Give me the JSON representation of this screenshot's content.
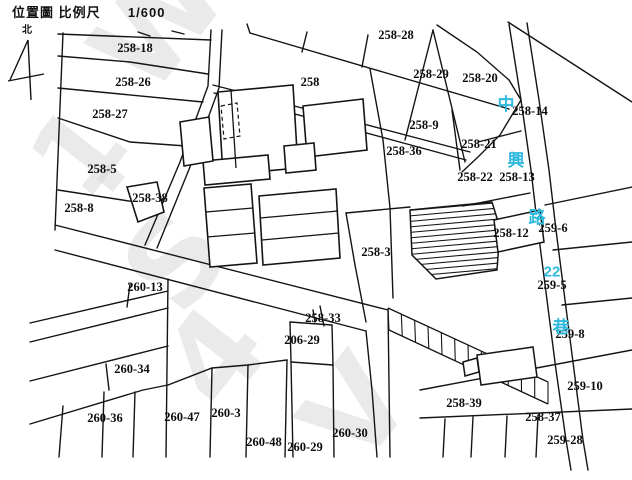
{
  "header": {
    "title": "位置圖",
    "scale_label": "比例尺",
    "scale_value": "1/600",
    "north_label": "北"
  },
  "map": {
    "canvas": {
      "w": 632,
      "h": 480,
      "bg": "#ffffff",
      "line_color": "#141414",
      "label_color": "#0c0c0c",
      "road_name_color": "#2fb9dc",
      "watermark_color": "#d9d9d9"
    },
    "street": {
      "name": "中興路22巷",
      "color": "#2fb9dc",
      "chars": [
        {
          "t": "中",
          "x": 506,
          "y": 104,
          "s": 17
        },
        {
          "t": "興",
          "x": 516,
          "y": 160,
          "s": 17
        },
        {
          "t": "路",
          "x": 537,
          "y": 217,
          "s": 17
        },
        {
          "t": "22",
          "x": 552,
          "y": 271,
          "s": 15
        },
        {
          "t": "巷",
          "x": 561,
          "y": 327,
          "s": 17
        }
      ]
    },
    "parcel_labels": [
      {
        "t": "258-18",
        "x": 135,
        "y": 48
      },
      {
        "t": "258-28",
        "x": 396,
        "y": 35
      },
      {
        "t": "258-29",
        "x": 431,
        "y": 74
      },
      {
        "t": "258-20",
        "x": 480,
        "y": 78
      },
      {
        "t": "258-26",
        "x": 133,
        "y": 82
      },
      {
        "t": "258",
        "x": 310,
        "y": 82
      },
      {
        "t": "258-14",
        "x": 530,
        "y": 111
      },
      {
        "t": "258-27",
        "x": 110,
        "y": 114
      },
      {
        "t": "258-9",
        "x": 424,
        "y": 125
      },
      {
        "t": "258-21",
        "x": 479,
        "y": 144
      },
      {
        "t": "258-36",
        "x": 404,
        "y": 151
      },
      {
        "t": "258-5",
        "x": 102,
        "y": 169
      },
      {
        "t": "258-22",
        "x": 475,
        "y": 177
      },
      {
        "t": "258-13",
        "x": 517,
        "y": 177
      },
      {
        "t": "258-38",
        "x": 150,
        "y": 198
      },
      {
        "t": "258-8",
        "x": 79,
        "y": 208
      },
      {
        "t": "259-6",
        "x": 553,
        "y": 228
      },
      {
        "t": "258-12",
        "x": 511,
        "y": 233
      },
      {
        "t": "258-3",
        "x": 376,
        "y": 252
      },
      {
        "t": "259-5",
        "x": 552,
        "y": 285
      },
      {
        "t": "260-13",
        "x": 145,
        "y": 287
      },
      {
        "t": "258-33",
        "x": 323,
        "y": 318
      },
      {
        "t": "259-8",
        "x": 570,
        "y": 334
      },
      {
        "t": "206-29",
        "x": 302,
        "y": 340
      },
      {
        "t": "260-34",
        "x": 132,
        "y": 369
      },
      {
        "t": "259-10",
        "x": 585,
        "y": 386
      },
      {
        "t": "258-39",
        "x": 464,
        "y": 403
      },
      {
        "t": "260-36",
        "x": 105,
        "y": 418
      },
      {
        "t": "260-47",
        "x": 182,
        "y": 417
      },
      {
        "t": "260-3",
        "x": 226,
        "y": 413
      },
      {
        "t": "258-37",
        "x": 543,
        "y": 417
      },
      {
        "t": "260-48",
        "x": 264,
        "y": 442
      },
      {
        "t": "260-29",
        "x": 305,
        "y": 447
      },
      {
        "t": "260-30",
        "x": 350,
        "y": 433
      },
      {
        "t": "259-28",
        "x": 565,
        "y": 440
      }
    ],
    "watermark": [
      {
        "char": "W",
        "x": 150,
        "y": 100,
        "size": 120,
        "rot": -52
      },
      {
        "char": "1",
        "x": 85,
        "y": 205,
        "size": 110,
        "rot": -52
      },
      {
        "char": "·",
        "x": 128,
        "y": 218,
        "size": 110,
        "rot": -52
      },
      {
        "char": "S",
        "x": 182,
        "y": 320,
        "size": 120,
        "rot": -52
      },
      {
        "char": "4",
        "x": 222,
        "y": 415,
        "size": 120,
        "rot": -52
      },
      {
        "char": "V",
        "x": 360,
        "y": 472,
        "size": 120,
        "rot": -52
      }
    ],
    "geometry": {
      "parcel_lines": [
        [
          58,
          34,
          211,
          40
        ],
        [
          58,
          56,
          130,
          62,
          208,
          74
        ],
        [
          58,
          88,
          203,
          102
        ],
        [
          58,
          118,
          130,
          142,
          186,
          146
        ],
        [
          58,
          190,
          161,
          206
        ],
        [
          63,
          33,
          55,
          230
        ],
        [
          211,
          30,
          208,
          86,
          180,
          162,
          145,
          245
        ],
        [
          222,
          30,
          219,
          88,
          192,
          162,
          157,
          248
        ],
        [
          55,
          225,
          388,
          310
        ],
        [
          55,
          250,
          366,
          331
        ],
        [
          366,
          331,
          372,
          390,
          377,
          457
        ],
        [
          388,
          310,
          390,
          457
        ],
        [
          250,
          33,
          509,
          109
        ],
        [
          250,
          33,
          247,
          24
        ],
        [
          368,
          35,
          362,
          67
        ],
        [
          307,
          32,
          302,
          52
        ],
        [
          138,
          32,
          150,
          36
        ],
        [
          172,
          31,
          184,
          34
        ],
        [
          433,
          30,
          405,
          140
        ],
        [
          433,
          30,
          465,
          162
        ],
        [
          437,
          25,
          477,
          52,
          509,
          80,
          521,
          100
        ],
        [
          509,
          24,
          521,
          100,
          531,
          170,
          538,
          230,
          547,
          300,
          556,
          370,
          566,
          440,
          571,
          470
        ],
        [
          527,
          23,
          539,
          100,
          549,
          170,
          556,
          230,
          565,
          300,
          574,
          370,
          583,
          440,
          588,
          470
        ],
        [
          508,
          22,
          632,
          102
        ],
        [
          521,
          100,
          500,
          135,
          478,
          157,
          462,
          172
        ],
        [
          452,
          110,
          460,
          170
        ],
        [
          463,
          206,
          530,
          193
        ],
        [
          478,
          142,
          521,
          131
        ],
        [
          213,
          85,
          337,
          117,
          470,
          152
        ],
        [
          214,
          93,
          337,
          125,
          466,
          160
        ],
        [
          370,
          69,
          383,
          140,
          390,
          208,
          393,
          298
        ],
        [
          545,
          205,
          632,
          187
        ],
        [
          553,
          250,
          632,
          242
        ],
        [
          562,
          305,
          632,
          298
        ],
        [
          420,
          390,
          632,
          350
        ],
        [
          420,
          418,
          632,
          409
        ],
        [
          445,
          419,
          443,
          457
        ],
        [
          473,
          417,
          471,
          457
        ],
        [
          507,
          416,
          505,
          457
        ],
        [
          538,
          415,
          536,
          457
        ],
        [
          346,
          213,
          355,
          265,
          366,
          322
        ],
        [
          346,
          213,
          410,
          207
        ],
        [
          168,
          279,
          166,
          457
        ],
        [
          30,
          323,
          168,
          291
        ],
        [
          130,
          284,
          127,
          307
        ],
        [
          30,
          342,
          168,
          308
        ],
        [
          30,
          381,
          168,
          346
        ],
        [
          30,
          424,
          143,
          390,
          168,
          385
        ],
        [
          106,
          364,
          109,
          390
        ],
        [
          104,
          392,
          102,
          457
        ],
        [
          63,
          406,
          59,
          457
        ],
        [
          135,
          392,
          133,
          457
        ],
        [
          168,
          385,
          212,
          368,
          248,
          365,
          287,
          360
        ],
        [
          212,
          368,
          210,
          457
        ],
        [
          248,
          365,
          246,
          457
        ],
        [
          287,
          360,
          285,
          457
        ],
        [
          290,
          322,
          291,
          362
        ],
        [
          332,
          325,
          333,
          365
        ],
        [
          290,
          322,
          332,
          325
        ],
        [
          291,
          362,
          333,
          365
        ],
        [
          291,
          362,
          293,
          457
        ],
        [
          333,
          365,
          334,
          457
        ],
        [
          320,
          306,
          324,
          326
        ],
        [
          313,
          310,
          315,
          322
        ]
      ],
      "dashed_lines": [
        [
          221,
          106,
          237,
          103,
          240,
          136,
          224,
          139,
          221,
          106
        ]
      ],
      "buildings": [
        [
          218,
          92,
          293,
          85,
          298,
          168,
          223,
          175
        ],
        [
          303,
          106,
          363,
          99,
          367,
          150,
          307,
          157
        ],
        [
          284,
          146,
          314,
          143,
          316,
          170,
          286,
          173
        ],
        [
          203,
          161,
          268,
          155,
          270,
          179,
          205,
          185
        ],
        [
          204,
          188,
          251,
          184,
          257,
          263,
          210,
          267
        ],
        [
          259,
          196,
          336,
          189,
          340,
          258,
          263,
          265
        ],
        [
          180,
          122,
          209,
          117,
          213,
          161,
          184,
          166
        ],
        [
          127,
          187,
          157,
          182,
          164,
          212,
          138,
          222
        ]
      ],
      "building_inner_lines": [
        [
          231,
          90,
          236,
          168
        ],
        [
          206,
          212,
          253,
          208
        ],
        [
          207,
          237,
          255,
          233
        ],
        [
          260,
          218,
          338,
          211
        ],
        [
          262,
          240,
          339,
          233
        ]
      ],
      "buildings_over": [
        [
          494,
          220,
          540,
          210,
          544,
          242,
          498,
          252
        ],
        [
          477,
          355,
          533,
          347,
          537,
          377,
          481,
          385
        ],
        [
          463,
          362,
          477,
          358,
          479,
          372,
          465,
          376
        ]
      ],
      "hatch_main": {
        "poly": [
          410,
          210,
          492,
          202,
          500,
          228,
          497,
          270,
          436,
          279,
          412,
          255
        ],
        "x1": 403,
        "x2": 505,
        "y_start": 200,
        "drop": 9,
        "step": 5.5,
        "count": 15
      },
      "hatch_band": {
        "top": [
          388,
          308,
          548,
          382
        ],
        "bottom": [
          389,
          330,
          548,
          404
        ],
        "rungs": 12
      },
      "north_arrow": [
        [
          28,
          40,
          31,
          100
        ],
        [
          28,
          40,
          10,
          80
        ],
        [
          8,
          81,
          44,
          74
        ]
      ],
      "north_label_pos": {
        "x": 27,
        "y": 33
      }
    }
  }
}
